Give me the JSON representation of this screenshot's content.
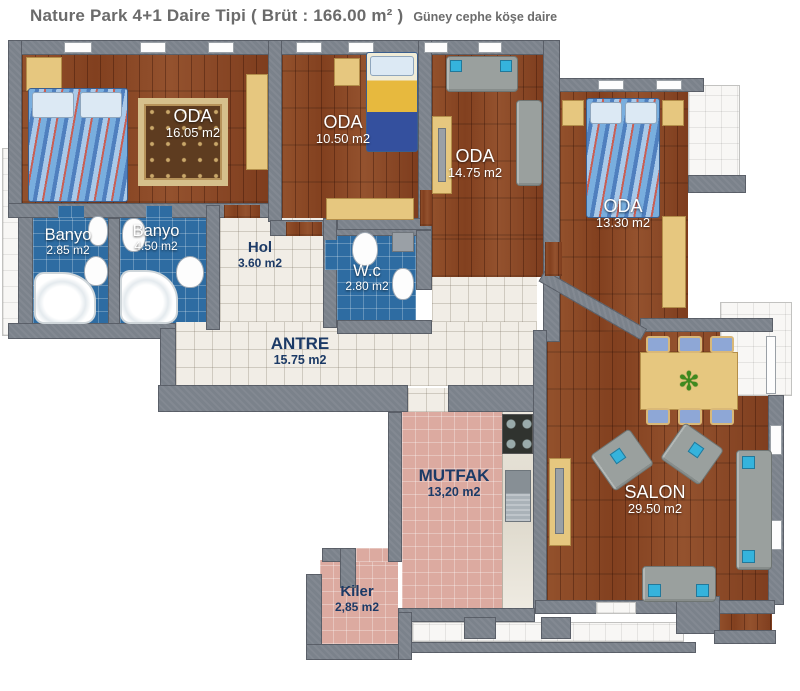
{
  "header": {
    "title": "Nature Park 4+1 Daire Tipi ( Brüt : 166.00 m² )",
    "subtitle": "Güney cephe köşe daire"
  },
  "rooms": [
    {
      "id": "oda-1",
      "name": "ODA",
      "area": "16.05 m2"
    },
    {
      "id": "oda-2",
      "name": "ODA",
      "area": "10.50 m2"
    },
    {
      "id": "oda-3",
      "name": "ODA",
      "area": "14.75 m2"
    },
    {
      "id": "oda-4",
      "name": "ODA",
      "area": "13.30 m2"
    },
    {
      "id": "banyo-1",
      "name": "Banyo",
      "area": "2.85 m2"
    },
    {
      "id": "banyo-2",
      "name": "Banyo",
      "area": "4.50 m2"
    },
    {
      "id": "hol",
      "name": "Hol",
      "area": "3.60 m2"
    },
    {
      "id": "wc",
      "name": "W.c",
      "area": "2.80 m2"
    },
    {
      "id": "antre",
      "name": "ANTRE",
      "area": "15.75 m2"
    },
    {
      "id": "mutfak",
      "name": "MUTFAK",
      "area": "13,20 m2"
    },
    {
      "id": "salon",
      "name": "SALON",
      "area": "29.50 m2"
    },
    {
      "id": "kiler",
      "name": "Kiler",
      "area": "2,85 m2"
    }
  ],
  "colors": {
    "wall": "#7b828b",
    "wood_floor": "#8a4526",
    "blue_tile": "#2e6ca2",
    "white_tile": "#f1ede6",
    "pink_tile": "#dcaaa0",
    "label_navy": "#1c3a66",
    "label_white": "#ffffff",
    "title_gray": "#6b6b6b",
    "accent_blue": "#35b3dc",
    "furniture_beige": "#e6c77f"
  }
}
